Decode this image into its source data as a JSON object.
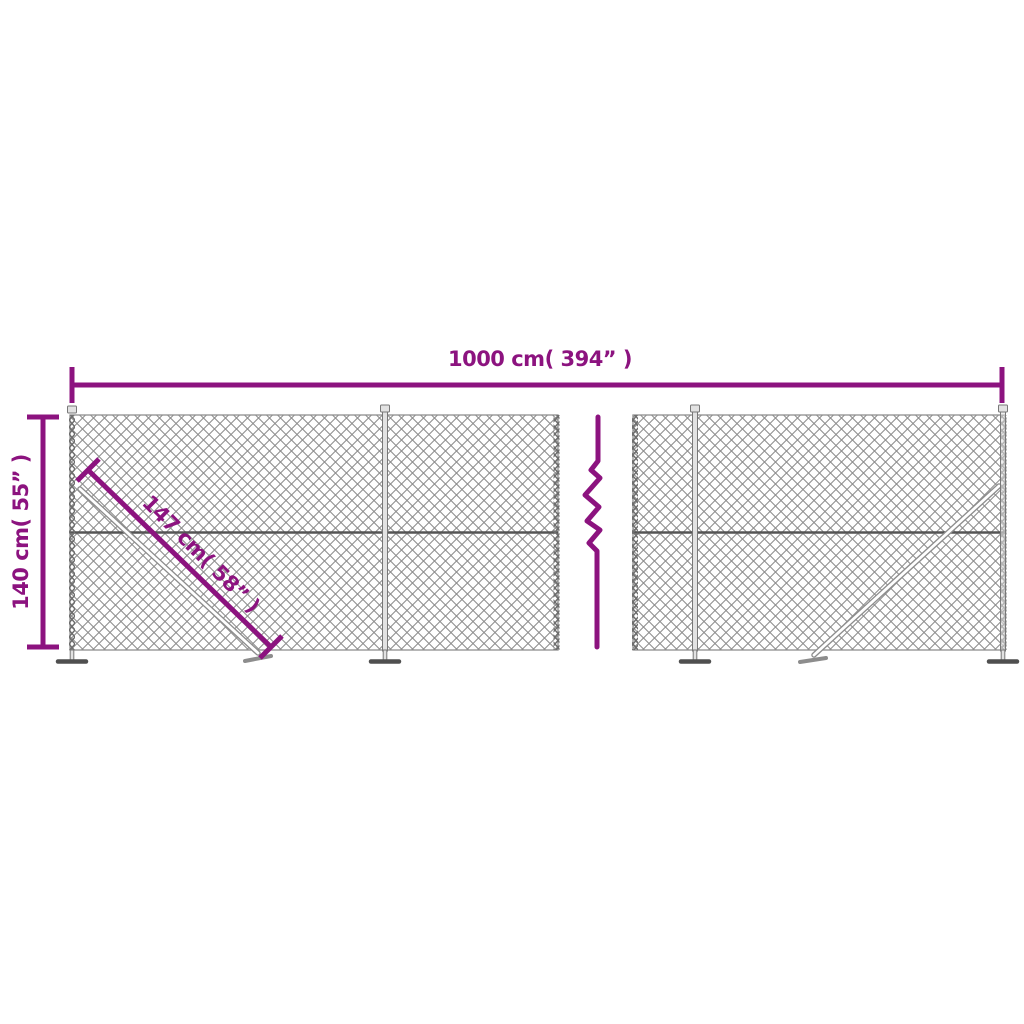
{
  "colors": {
    "accent": "#8c137f",
    "mesh": "#8f8f8f",
    "rail": "#555555",
    "hardware_outline": "#787878",
    "hardware_fill": "#e2e2e2",
    "foot": "#4f4f4f",
    "background": "#ffffff"
  },
  "dimensions": {
    "width": {
      "label": "1000 cm( 394” )",
      "cm": 1000,
      "inches": 394
    },
    "height": {
      "label": "140 cm( 55” )",
      "cm": 140,
      "inches": 55
    },
    "diagonal": {
      "label": "147 cm( 58” )",
      "cm": 147,
      "inches": 58
    }
  },
  "icons": {
    "break": "break-zigzag-icon",
    "mesh": "chain-link-mesh",
    "post_foot": "flange-foot-icon",
    "brace": "diagonal-brace"
  }
}
